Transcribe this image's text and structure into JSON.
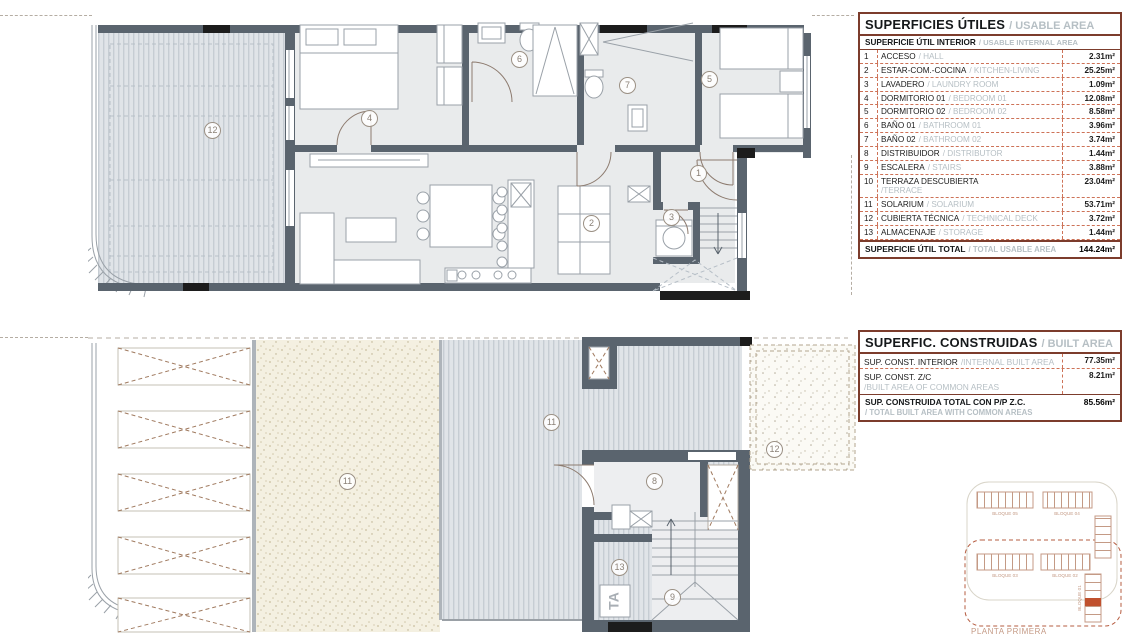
{
  "tables": {
    "usable": {
      "title": "SUPERFICIES ÚTILES",
      "title_en": "/ USABLE AREA",
      "subtitle": "SUPERFICIE ÚTIL INTERIOR",
      "subtitle_en": "/ USABLE INTERNAL AREA",
      "rows": [
        {
          "num": "1",
          "name": "ACCESO",
          "name_en": "/ HALL",
          "value": "2.31m²"
        },
        {
          "num": "2",
          "name": "ESTAR-COM.-COCINA",
          "name_en": "/ KITCHEN-LIVING",
          "value": "25.25m²"
        },
        {
          "num": "3",
          "name": "LAVADERO",
          "name_en": "/ LAUNDRY ROOM",
          "value": "1.09m²"
        },
        {
          "num": "4",
          "name": "DORMITORIO 01",
          "name_en": "/ BEDROOM 01",
          "value": "12.08m²"
        },
        {
          "num": "5",
          "name": "DORMITORIO 02",
          "name_en": "/ BEDROOM 02",
          "value": "8.58m²"
        },
        {
          "num": "6",
          "name": "BAÑO 01",
          "name_en": "/ BATHROOM 01",
          "value": "3.96m²"
        },
        {
          "num": "7",
          "name": "BAÑO 02",
          "name_en": "/ BATHROOM 02",
          "value": "3.74m²"
        },
        {
          "num": "8",
          "name": "DISTRIBUIDOR",
          "name_en": "/ DISTRIBUTOR",
          "value": "1.44m²"
        },
        {
          "num": "9",
          "name": "ESCALERA",
          "name_en": "/ STAIRS",
          "value": "3.88m²"
        },
        {
          "num": "10",
          "name": "TERRAZA DESCUBIERTA",
          "name_en": "/TERRACE",
          "value": "23.04m²"
        },
        {
          "num": "11",
          "name": "SOLARIUM",
          "name_en": "/ SOLARIUM",
          "value": "53.71m²"
        },
        {
          "num": "12",
          "name": "CUBIERTA TÉCNICA",
          "name_en": "/ TECHNICAL DECK",
          "value": "3.72m²"
        },
        {
          "num": "13",
          "name": "ALMACENAJE",
          "name_en": "/ STORAGE",
          "value": "1.44m²"
        }
      ],
      "total_label": "SUPERFICIE ÚTIL TOTAL",
      "total_label_en": "/ TOTAL USABLE AREA",
      "total_value": "144.24m²"
    },
    "built": {
      "title": "SUPERFIC. CONSTRUIDAS",
      "title_en": "/ BUILT AREA",
      "rows": [
        {
          "name": "SUP. CONST. INTERIOR",
          "name_en": "/INTERNAL BUILT AREA",
          "value": "77.35m²"
        },
        {
          "name": "SUP. CONST. Z/C",
          "name_en": "/BUILT AREA OF COMMON AREAS",
          "value": "8.21m²"
        }
      ],
      "total_label": "SUP. CONSTRUIDA TOTAL CON P/P Z.C.",
      "total_label_en": "/ TOTAL BUILT AREA WITH COMMON AREAS",
      "total_value": "85.56m²"
    }
  },
  "plans": {
    "upper": {
      "labels": {
        "deck": "12",
        "bedroom1": "4",
        "bath1": "6",
        "bath2": "7",
        "bedroom2": "5",
        "hall": "1",
        "laundry": "3",
        "living": "2"
      }
    },
    "lower": {
      "labels": {
        "solarium": "11",
        "terrace": "11",
        "distributor": "8",
        "storage": "13",
        "stairs": "9",
        "techdeck": "12"
      },
      "lift_text": "TA"
    }
  },
  "legend": {
    "blocks": [
      "BLOQUE 05",
      "BLOQUE 04",
      "BLOQUE 03",
      "BLOQUE 02",
      "BLOQUE 01"
    ],
    "caption": "PLANTA PRIMERA"
  },
  "colors": {
    "wall": "#5a646e",
    "wall-black": "#1c1c1c",
    "floor": "#e9ebec",
    "table-border": "#7c3c2c",
    "dash": "#cd7257",
    "gray-text": "#b6bfc4",
    "circle-border": "#9b9084",
    "circle-text": "#8b8177",
    "accent-red": "#c0512e"
  }
}
